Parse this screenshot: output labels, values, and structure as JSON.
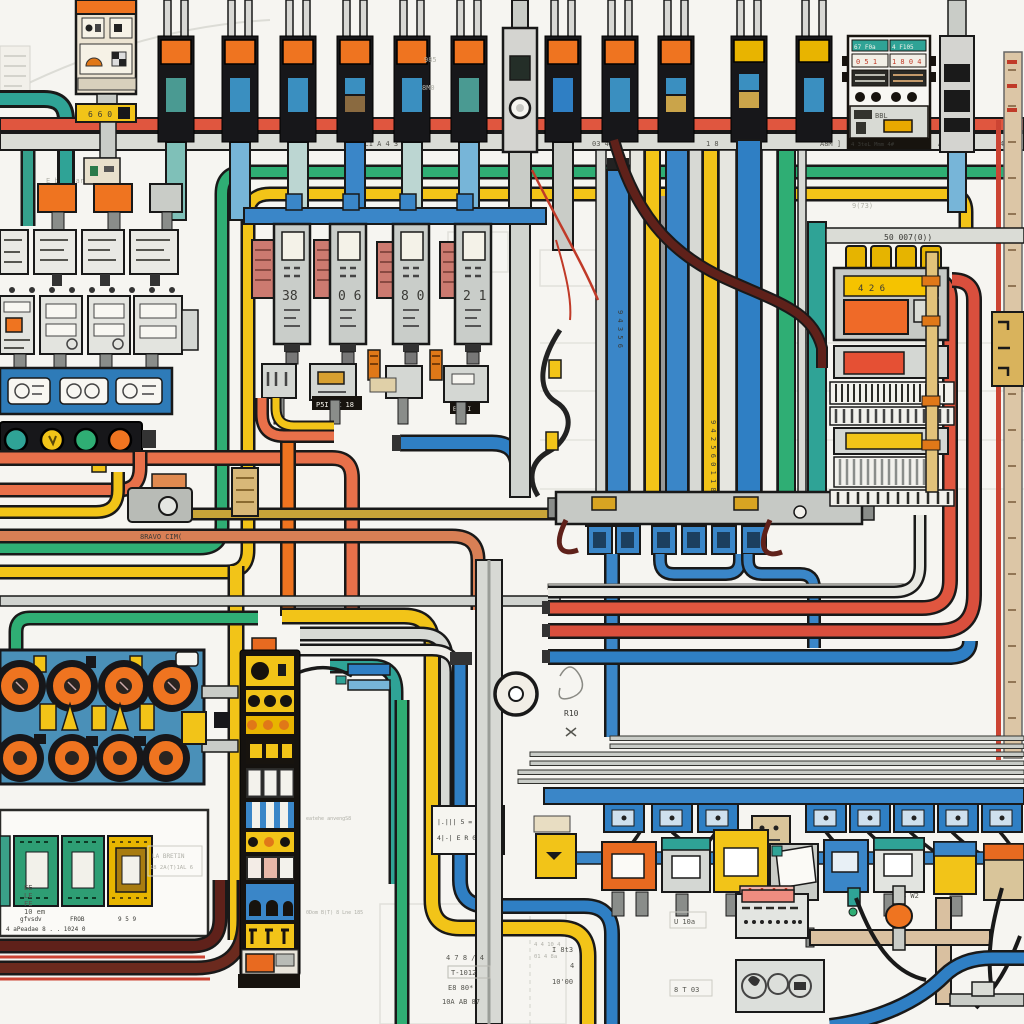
{
  "diagram": {
    "kind": "stylized electrical wiring / control-panel schematic illustration",
    "palette": {
      "background": "#f6f5f1",
      "outline": "#191919",
      "red": "#d94f3d",
      "salmon": "#e8704a",
      "orange": "#ef7420",
      "yellow": "#f2c418",
      "amber": "#d8a422",
      "olive": "#c8a438",
      "green": "#2fae74",
      "teal": "#2fa396",
      "blue": "#2f7fc4",
      "lightblue": "#77b5d8",
      "gray": "#c9ccc9",
      "lightgray": "#dadcd6",
      "tan": "#d9c0a0",
      "cream": "#ece4d2",
      "maroon": "#5f211a",
      "board_blue": "#4a90b8",
      "black_component": "#17171a"
    },
    "inventory": {
      "top_breakers": {
        "count": 12,
        "cap_color": "#ef7420",
        "body_color": "#17171a",
        "window_colors": [
          "#4a9a92",
          "#3a8fc0",
          "#3a8fc0",
          "#8a6a40",
          "#3a8fc0",
          "#4a9a92",
          "#2f7fc4",
          "#3a8fc0",
          "#caa44a",
          "#3a8fc0",
          "#caa44a",
          "#b5884a"
        ]
      },
      "bus_indicator_dots": [
        "#2fa396",
        "#f2c418",
        "#2fae74",
        "#ef7420"
      ],
      "relay_modules": {
        "small_row": 4,
        "large_row": 4
      },
      "meter_towers": {
        "count": 4,
        "digits": [
          "38",
          "0 6",
          "8 0",
          "2 1"
        ]
      },
      "dial_panel": {
        "rows": 2,
        "dials_per_row": 4,
        "dial_color": "#ef7420",
        "board_color": "#4a90b8"
      },
      "terminal_strip_rows": 10,
      "din_clamps": {
        "count": 8,
        "color": "#2f7fc4"
      },
      "device_row_colors": [
        "#f2c418",
        "#e86a20",
        "#2fa396",
        "#f2c418",
        "#c9ccc7",
        "#2f7fc4",
        "#2fa396",
        "#f2c418",
        "#e86a20"
      ]
    },
    "labels": {
      "brk_label": "6 6 0",
      "t_bus_a": "A 4",
      "t_bus_b": "K3L1 A 4 3 1a",
      "t_bus_c": "03 4L",
      "t_bus_e": "1 8",
      "t_bus_d": "A8M ]",
      "t_bus_f": "A P C",
      "t_bus_g": "4L",
      "note_985": "985",
      "note_8m0": "8M0",
      "note_973": "9(73)",
      "p_h1": "67 F0a",
      "p_h2": "4 F105",
      "p_d1": "0 5 1",
      "p_d2": "1 8 0 4",
      "p_low": "BBL",
      "p_foot": "4 3teL Mmm 4#",
      "d_bus": "50 007(0))",
      "d_strip": "4 2 6",
      "d_note": "8 W2",
      "tw1": "38",
      "tw2": "0 6",
      "tw3": "8 0",
      "tw4": "2 1",
      "tw_tag": "P5I RZ 18",
      "tw_tag2": "B 3 I",
      "bar_b": "9 4 3 5 6",
      "bar_y": "9 4 2 5 6  0 1 1 8 8  9 8 4",
      "valve_label": "8RAVO CIM(",
      "washer_note": "R10",
      "lb1": "|.||| 5 = 0)",
      "lb2": "4|-| E R 0( 88)",
      "bl_1": "gfvsdv",
      "bl_2": "FROB",
      "bl_3": "9 5 9",
      "bl_c1": "EE",
      "bl_c2": "LE",
      "bl_c3": "FE",
      "bl_c4": "10 em",
      "bl_f1": "LA BRETIN",
      "bl_f2": "18 2A(T)1AL 6",
      "bl_row": "4 aPeadae  8 . .  1024 0",
      "bm1": "4 7 8 / 4",
      "bm2": "T-1012",
      "bm3": "E8 80*",
      "bm4": "10A AB 87",
      "bm5": "I 8t3",
      "bm6": "4",
      "bm7": "10'00",
      "bm8": "U 10a",
      "bm9": "8 T 03",
      "f_note": "E bfevearCew T",
      "f_col1": "4 4 10 4",
      "f_col2": "01 4 8a",
      "st1": "eatehe anvengS8",
      "st2": "0Dom B(T) 8 Lne 185"
    }
  }
}
